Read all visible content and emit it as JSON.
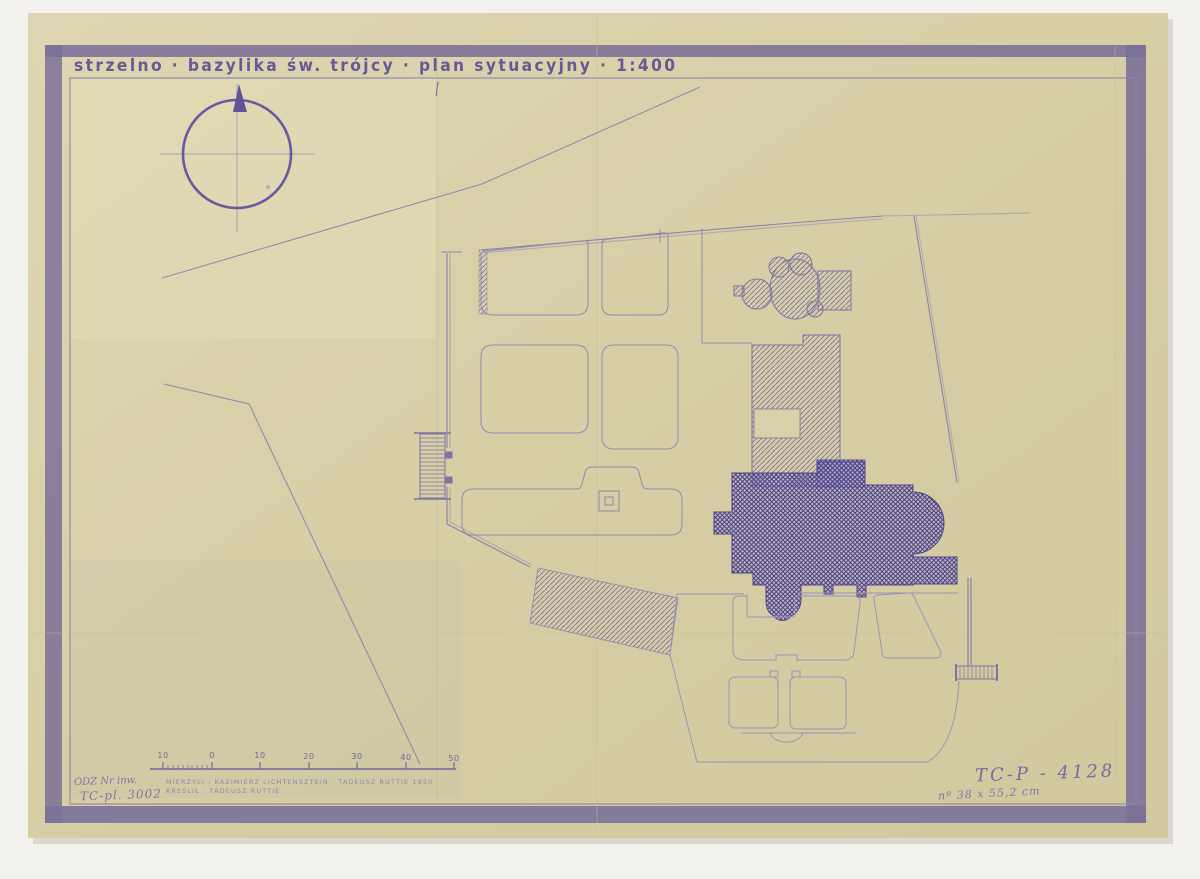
{
  "sheet": {
    "title": "strzelno · bazylika św. trójcy · plan sytuacyjny · 1:400"
  },
  "scale_bar": {
    "labels": [
      "10",
      "0",
      "10",
      "20",
      "30",
      "40",
      "50"
    ]
  },
  "credits": {
    "line1": "MIERZYLI : KAZIMIERZ LICHTENSZTEIN · TADEUSZ RUTTIE 1950",
    "line2": "KREŚLIŁ : TADEUSZ RUTTIE"
  },
  "annotations": {
    "inventory_line1": "ODZ Nr inw.",
    "inventory_line2": "TC-pl. 3002",
    "catalog_number": "TC-P - 4128",
    "size_note": "nº 38 x 55,2 cm"
  },
  "colors": {
    "paper": "#d8cfa6",
    "border_band": "#7b7199",
    "ink": "#6f66a0",
    "ink_dark": "#4d4390",
    "ink_light": "#938cb4",
    "crease": "#c8bf98"
  }
}
